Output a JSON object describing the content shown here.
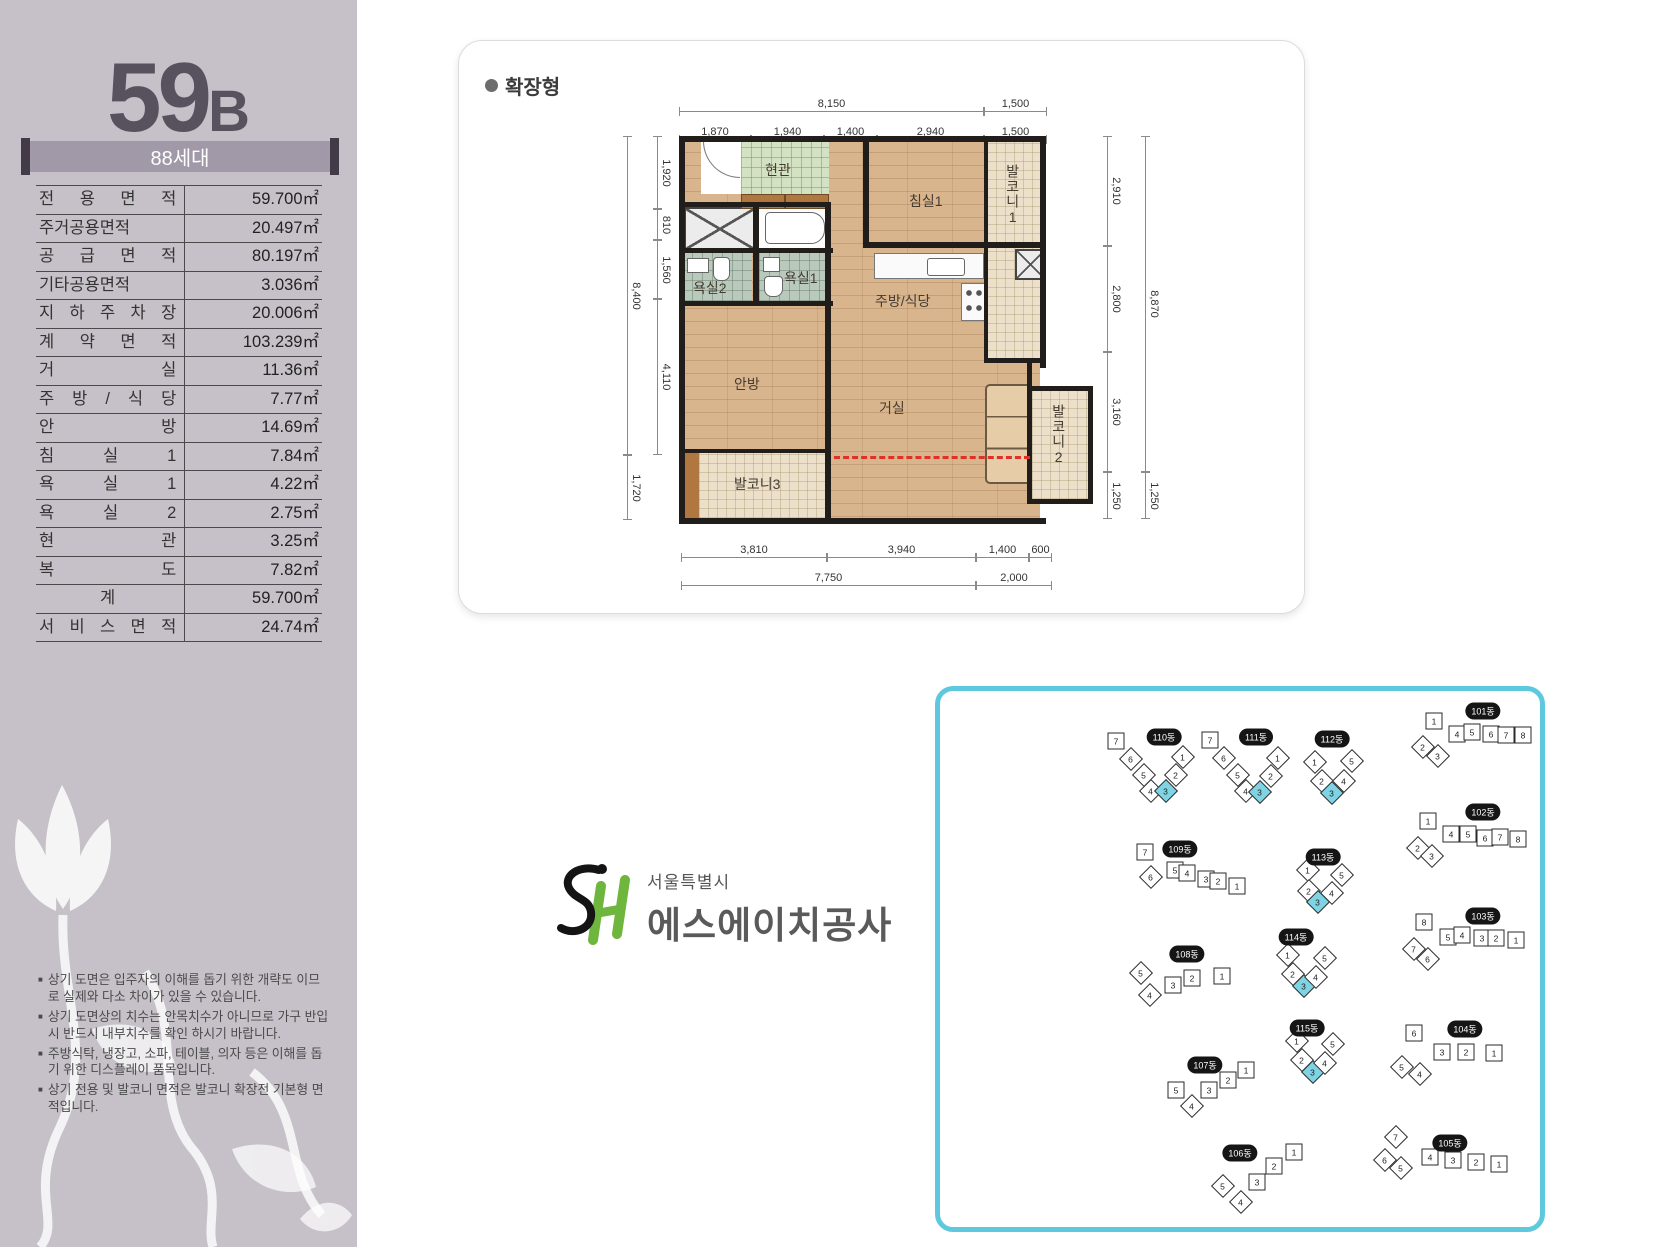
{
  "colors": {
    "accent_cyan": "#5ec9de",
    "highlight_unit": "#7fd4e4",
    "sh_green": "#6eb63d",
    "band_bg": "#a198a8",
    "sidebar_bg": "#c6c1c9",
    "red_dashed": "#e03028"
  },
  "sidebar": {
    "type_number": "59",
    "type_suffix": "B",
    "households_badge": "88세대",
    "area_table": {
      "rows": [
        {
          "label": "전 용 면 적",
          "value": "59.700㎡"
        },
        {
          "label": "주거공용면적",
          "value": "20.497㎡"
        },
        {
          "label": "공 급 면 적",
          "value": "80.197㎡"
        },
        {
          "label": "기타공용면적",
          "value": "3.036㎡"
        },
        {
          "label": "지 하 주 차 장",
          "value": "20.006㎡"
        },
        {
          "label": "계 약 면 적",
          "value": "103.239㎡"
        },
        {
          "label": "거 실",
          "value": "11.36㎡"
        },
        {
          "label": "주 방 / 식 당",
          "value": "7.77㎡"
        },
        {
          "label": "안 방",
          "value": "14.69㎡"
        },
        {
          "label": "침 실 1",
          "value": "7.84㎡"
        },
        {
          "label": "욕 실 1",
          "value": "4.22㎡"
        },
        {
          "label": "욕 실 2",
          "value": "2.75㎡"
        },
        {
          "label": "현 관",
          "value": "3.25㎡"
        },
        {
          "label": "복 도",
          "value": "7.82㎡"
        },
        {
          "label": "계",
          "value": "59.700㎡",
          "center": true
        },
        {
          "label": "서 비 스 면 적",
          "value": "24.74㎡"
        }
      ]
    },
    "notes": [
      "상기 도면은 입주자의 이해를 돕기 위한 개략도 이므로 실제와 다소 차이가 있을 수 있습니다.",
      "상기 도면상의 치수는 안목치수가 아니므로 가구 반입시 반드시 내부치수를 확인 하시기 바랍니다.",
      "주방식탁, 냉장고, 소파, 테이블, 의자 등은 이해를 돕기 위한 디스플레이 품목입니다.",
      "상기 전용 및 발코니 면적은 발코니 확장전 기본형 면적입니다."
    ]
  },
  "floorplan": {
    "mode_label": "확장형",
    "rooms": {
      "entrance": "현관",
      "bedroom1": "침실1",
      "balcony1": "발코니1",
      "bath1": "욕실1",
      "bath2": "욕실2",
      "kitchen": "주방/식당",
      "master": "안방",
      "living": "거실",
      "balcony2": "발코니2",
      "balcony3": "발코니3"
    },
    "dims": {
      "top_row1": [
        "8,150",
        "1,500"
      ],
      "top_row2": [
        "1,870",
        "1,940",
        "1,400",
        "2,940",
        "1,500"
      ],
      "left_outer": [
        "8,400",
        "1,720"
      ],
      "left_inner": [
        "1,920",
        "810",
        "1,560",
        "4,110"
      ],
      "right_inner": [
        "2,910",
        "2,800",
        "3,160",
        "1,250"
      ],
      "right_outer": [
        "8,870",
        "1,250"
      ],
      "bottom_row1": [
        "3,810",
        "3,940",
        "1,400",
        "600"
      ],
      "bottom_row2": [
        "7,750",
        "2,000"
      ]
    }
  },
  "logo": {
    "initials": "SH",
    "city": "서울특별시",
    "company": "에스에이치공사"
  },
  "siteplan": {
    "buildings": [
      {
        "name": "110동",
        "lx": 224,
        "ly": 46,
        "units": [
          {
            "n": "7",
            "x": 176,
            "y": 50,
            "sh": "s"
          },
          {
            "n": "6",
            "x": 191,
            "y": 68,
            "sh": "d"
          },
          {
            "n": "5",
            "x": 204,
            "y": 84,
            "sh": "d"
          },
          {
            "n": "4",
            "x": 211,
            "y": 100,
            "sh": "d"
          },
          {
            "n": "3",
            "x": 226,
            "y": 100,
            "sh": "d",
            "hl": true
          },
          {
            "n": "2",
            "x": 236,
            "y": 84,
            "sh": "d"
          },
          {
            "n": "1",
            "x": 243,
            "y": 66,
            "sh": "d"
          }
        ]
      },
      {
        "name": "111동",
        "lx": 316,
        "ly": 46,
        "units": [
          {
            "n": "7",
            "x": 270,
            "y": 49,
            "sh": "s"
          },
          {
            "n": "6",
            "x": 284,
            "y": 67,
            "sh": "d"
          },
          {
            "n": "5",
            "x": 298,
            "y": 84,
            "sh": "d"
          },
          {
            "n": "4",
            "x": 306,
            "y": 100,
            "sh": "d"
          },
          {
            "n": "3",
            "x": 320,
            "y": 101,
            "sh": "d",
            "hl": true
          },
          {
            "n": "2",
            "x": 331,
            "y": 85,
            "sh": "d"
          },
          {
            "n": "1",
            "x": 338,
            "y": 67,
            "sh": "d"
          }
        ]
      },
      {
        "name": "112동",
        "lx": 392,
        "ly": 48,
        "units": [
          {
            "n": "1",
            "x": 375,
            "y": 71,
            "sh": "d"
          },
          {
            "n": "2",
            "x": 382,
            "y": 90,
            "sh": "d"
          },
          {
            "n": "3",
            "x": 392,
            "y": 102,
            "sh": "d",
            "hl": true
          },
          {
            "n": "4",
            "x": 404,
            "y": 90,
            "sh": "d"
          },
          {
            "n": "5",
            "x": 412,
            "y": 70,
            "sh": "d"
          }
        ]
      },
      {
        "name": "101동",
        "lx": 543,
        "ly": 20,
        "units": [
          {
            "n": "1",
            "x": 494,
            "y": 30,
            "sh": "s"
          },
          {
            "n": "2",
            "x": 483,
            "y": 56,
            "sh": "d"
          },
          {
            "n": "3",
            "x": 498,
            "y": 65,
            "sh": "d"
          },
          {
            "n": "4",
            "x": 517,
            "y": 43,
            "sh": "s"
          },
          {
            "n": "5",
            "x": 532,
            "y": 41,
            "sh": "s"
          },
          {
            "n": "6",
            "x": 551,
            "y": 43,
            "sh": "s"
          },
          {
            "n": "7",
            "x": 566,
            "y": 44,
            "sh": "s"
          },
          {
            "n": "8",
            "x": 583,
            "y": 44,
            "sh": "s"
          }
        ]
      },
      {
        "name": "109동",
        "lx": 240,
        "ly": 158,
        "units": [
          {
            "n": "7",
            "x": 205,
            "y": 161,
            "sh": "s"
          },
          {
            "n": "6",
            "x": 211,
            "y": 186,
            "sh": "d"
          },
          {
            "n": "5",
            "x": 235,
            "y": 179,
            "sh": "s"
          },
          {
            "n": "4",
            "x": 247,
            "y": 182,
            "sh": "s"
          },
          {
            "n": "3",
            "x": 266,
            "y": 188,
            "sh": "s"
          },
          {
            "n": "2",
            "x": 278,
            "y": 190,
            "sh": "s"
          },
          {
            "n": "1",
            "x": 297,
            "y": 195,
            "sh": "s"
          }
        ]
      },
      {
        "name": "113동",
        "lx": 383,
        "ly": 166,
        "units": [
          {
            "n": "1",
            "x": 368,
            "y": 179,
            "sh": "d"
          },
          {
            "n": "2",
            "x": 369,
            "y": 200,
            "sh": "d"
          },
          {
            "n": "3",
            "x": 378,
            "y": 211,
            "sh": "d",
            "hl": true
          },
          {
            "n": "4",
            "x": 392,
            "y": 202,
            "sh": "d"
          },
          {
            "n": "5",
            "x": 402,
            "y": 184,
            "sh": "d"
          }
        ]
      },
      {
        "name": "102동",
        "lx": 543,
        "ly": 121,
        "units": [
          {
            "n": "1",
            "x": 488,
            "y": 130,
            "sh": "s"
          },
          {
            "n": "2",
            "x": 478,
            "y": 157,
            "sh": "d"
          },
          {
            "n": "3",
            "x": 492,
            "y": 165,
            "sh": "d"
          },
          {
            "n": "4",
            "x": 511,
            "y": 143,
            "sh": "s"
          },
          {
            "n": "5",
            "x": 528,
            "y": 143,
            "sh": "s"
          },
          {
            "n": "6",
            "x": 545,
            "y": 147,
            "sh": "s"
          },
          {
            "n": "7",
            "x": 560,
            "y": 146,
            "sh": "s"
          },
          {
            "n": "8",
            "x": 578,
            "y": 148,
            "sh": "s"
          }
        ]
      },
      {
        "name": "108동",
        "lx": 247,
        "ly": 263,
        "units": [
          {
            "n": "5",
            "x": 201,
            "y": 282,
            "sh": "d"
          },
          {
            "n": "4",
            "x": 210,
            "y": 304,
            "sh": "d"
          },
          {
            "n": "3",
            "x": 233,
            "y": 294,
            "sh": "s"
          },
          {
            "n": "2",
            "x": 252,
            "y": 287,
            "sh": "s"
          },
          {
            "n": "1",
            "x": 282,
            "y": 285,
            "sh": "s"
          }
        ]
      },
      {
        "name": "114동",
        "lx": 356,
        "ly": 246,
        "units": [
          {
            "n": "1",
            "x": 348,
            "y": 264,
            "sh": "d"
          },
          {
            "n": "2",
            "x": 353,
            "y": 283,
            "sh": "d"
          },
          {
            "n": "3",
            "x": 364,
            "y": 295,
            "sh": "d",
            "hl": true
          },
          {
            "n": "4",
            "x": 376,
            "y": 286,
            "sh": "d"
          },
          {
            "n": "5",
            "x": 385,
            "y": 267,
            "sh": "d"
          }
        ]
      },
      {
        "name": "103동",
        "lx": 543,
        "ly": 225,
        "units": [
          {
            "n": "8",
            "x": 484,
            "y": 231,
            "sh": "s"
          },
          {
            "n": "7",
            "x": 474,
            "y": 258,
            "sh": "d"
          },
          {
            "n": "6",
            "x": 488,
            "y": 268,
            "sh": "d"
          },
          {
            "n": "5",
            "x": 508,
            "y": 246,
            "sh": "s"
          },
          {
            "n": "4",
            "x": 522,
            "y": 244,
            "sh": "s"
          },
          {
            "n": "3",
            "x": 542,
            "y": 247,
            "sh": "s"
          },
          {
            "n": "2",
            "x": 556,
            "y": 247,
            "sh": "s"
          },
          {
            "n": "1",
            "x": 576,
            "y": 249,
            "sh": "s"
          }
        ]
      },
      {
        "name": "107동",
        "lx": 265,
        "ly": 374,
        "units": [
          {
            "n": "5",
            "x": 236,
            "y": 399,
            "sh": "s"
          },
          {
            "n": "4",
            "x": 252,
            "y": 415,
            "sh": "d"
          },
          {
            "n": "3",
            "x": 269,
            "y": 399,
            "sh": "s"
          },
          {
            "n": "2",
            "x": 288,
            "y": 389,
            "sh": "s"
          },
          {
            "n": "1",
            "x": 306,
            "y": 379,
            "sh": "s"
          }
        ]
      },
      {
        "name": "115동",
        "lx": 367,
        "ly": 337,
        "units": [
          {
            "n": "1",
            "x": 357,
            "y": 350,
            "sh": "d"
          },
          {
            "n": "2",
            "x": 362,
            "y": 369,
            "sh": "d"
          },
          {
            "n": "3",
            "x": 373,
            "y": 381,
            "sh": "d",
            "hl": true
          },
          {
            "n": "4",
            "x": 385,
            "y": 372,
            "sh": "d"
          },
          {
            "n": "5",
            "x": 393,
            "y": 353,
            "sh": "d"
          }
        ]
      },
      {
        "name": "104동",
        "lx": 525,
        "ly": 338,
        "units": [
          {
            "n": "6",
            "x": 474,
            "y": 342,
            "sh": "s"
          },
          {
            "n": "5",
            "x": 462,
            "y": 376,
            "sh": "d"
          },
          {
            "n": "4",
            "x": 480,
            "y": 383,
            "sh": "d"
          },
          {
            "n": "3",
            "x": 502,
            "y": 361,
            "sh": "s"
          },
          {
            "n": "2",
            "x": 526,
            "y": 361,
            "sh": "s"
          },
          {
            "n": "1",
            "x": 554,
            "y": 362,
            "sh": "s"
          }
        ]
      },
      {
        "name": "106동",
        "lx": 300,
        "ly": 462,
        "units": [
          {
            "n": "1",
            "x": 354,
            "y": 461,
            "sh": "s"
          },
          {
            "n": "2",
            "x": 334,
            "y": 475,
            "sh": "s"
          },
          {
            "n": "3",
            "x": 317,
            "y": 491,
            "sh": "s"
          },
          {
            "n": "4",
            "x": 301,
            "y": 511,
            "sh": "d"
          },
          {
            "n": "5",
            "x": 283,
            "y": 495,
            "sh": "d"
          }
        ]
      },
      {
        "name": "105동",
        "lx": 510,
        "ly": 452,
        "units": [
          {
            "n": "7",
            "x": 456,
            "y": 446,
            "sh": "d"
          },
          {
            "n": "6",
            "x": 445,
            "y": 469,
            "sh": "d"
          },
          {
            "n": "5",
            "x": 461,
            "y": 477,
            "sh": "d"
          },
          {
            "n": "4",
            "x": 490,
            "y": 466,
            "sh": "s"
          },
          {
            "n": "3",
            "x": 513,
            "y": 469,
            "sh": "s"
          },
          {
            "n": "2",
            "x": 536,
            "y": 471,
            "sh": "s"
          },
          {
            "n": "1",
            "x": 559,
            "y": 473,
            "sh": "s"
          }
        ]
      }
    ]
  }
}
